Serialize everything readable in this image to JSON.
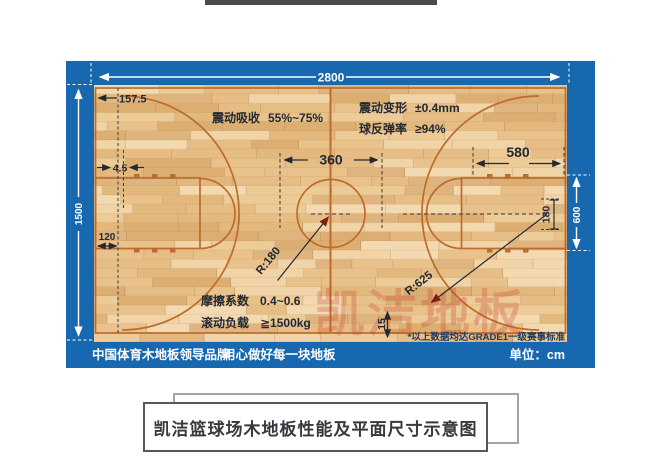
{
  "diagram": {
    "dimensions": {
      "court_length": "2800",
      "court_width": "1500",
      "baseline_offset": "157.5",
      "line_gap": "4.5",
      "lane_width": "120",
      "center_circle_diameter": "360",
      "key_top_width": "580",
      "key_zone_height": "600",
      "backboard_offset": "180",
      "apron": "15",
      "center_radius": "R:180",
      "three_point_radius": "R:625"
    },
    "specs": {
      "shock_absorption_label": "震动吸收",
      "shock_absorption_value": "55%~75%",
      "vibration_deform_label": "震动变形",
      "vibration_deform_value": "±0.4mm",
      "ball_rebound_label": "球反弹率",
      "ball_rebound_value": "≥94%",
      "friction_label": "摩擦系数",
      "friction_value": "0.4~0.6",
      "rolling_load_label": "滚动负载",
      "rolling_load_value": "≧1500kg"
    },
    "footnote": "*以上数据均达GRADE1一级赛事标准",
    "footer": {
      "slogan_left": "中国体育木地板领导品牌",
      "slogan_right": "用心做好每一块地板",
      "unit": "单位：cm"
    },
    "watermark": "凯洁地板",
    "colors": {
      "panel_blue": "#1768ae",
      "court_line": "#bd6c2c",
      "wood_base": "#e6c189",
      "arrow_red": "#7a1f12"
    }
  },
  "caption": {
    "title": "凯洁篮球场木地板性能及平面尺寸示意图"
  }
}
